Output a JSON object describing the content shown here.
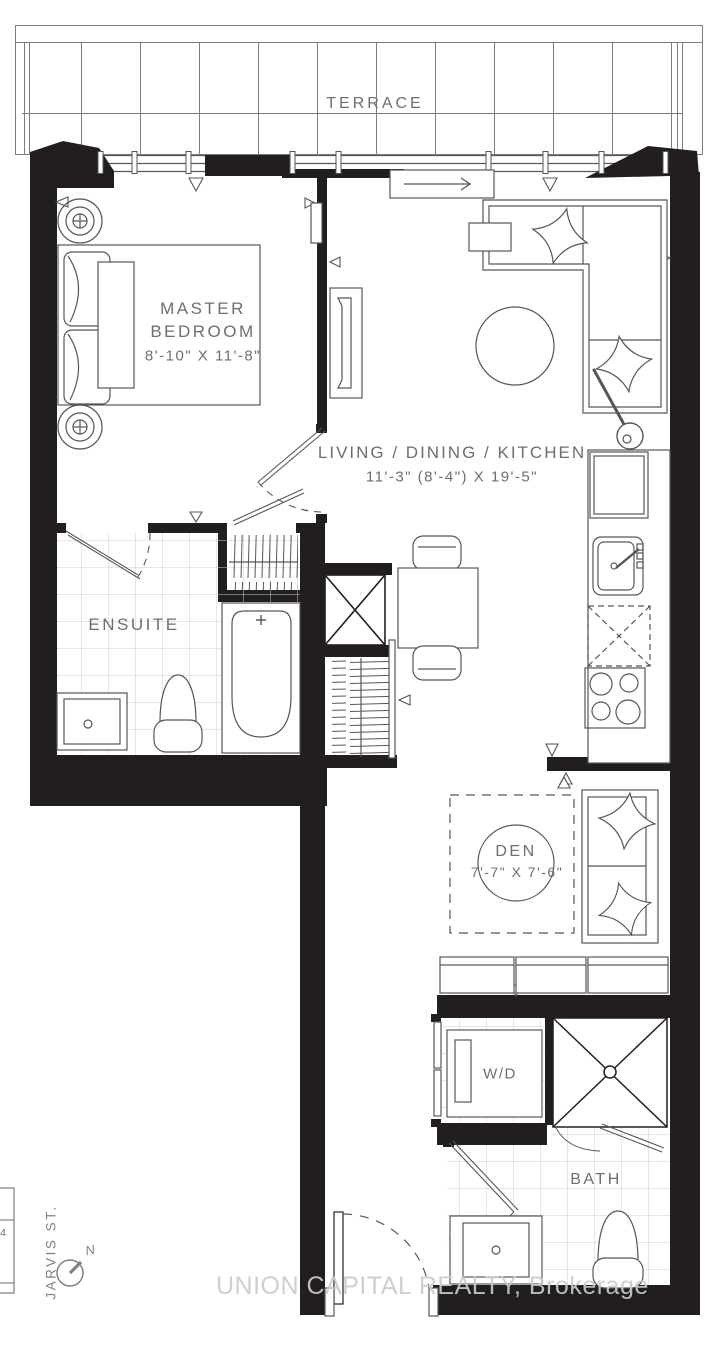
{
  "colors": {
    "wall": "#221e1f",
    "line": "#55565a",
    "label_text": "#6d6e71",
    "tile_line": "#cdced1",
    "watermark": "#c9cbcc"
  },
  "rooms": {
    "terrace": {
      "label": "TERRACE"
    },
    "master_bedroom": {
      "name_line1": "MASTER",
      "name_line2": "BEDROOM",
      "dims": "8'-10\" X 11'-8\""
    },
    "living_dining_kitchen": {
      "label": "LIVING / DINING / KITCHEN",
      "dims": "11'-3\" (8'-4\") X 19'-5\""
    },
    "ensuite": {
      "label": "ENSUITE"
    },
    "den": {
      "label": "DEN",
      "dims": "7'-7\" X 7'-6\""
    },
    "laundry": {
      "label": "W/D"
    },
    "bath": {
      "label": "BATH"
    }
  },
  "annotations": {
    "street_name": "JARVIS ST.",
    "compass_north": "N",
    "unit_edge_marker": "4",
    "watermark": "UNION CAPITAL REALTY, Brokerage"
  }
}
